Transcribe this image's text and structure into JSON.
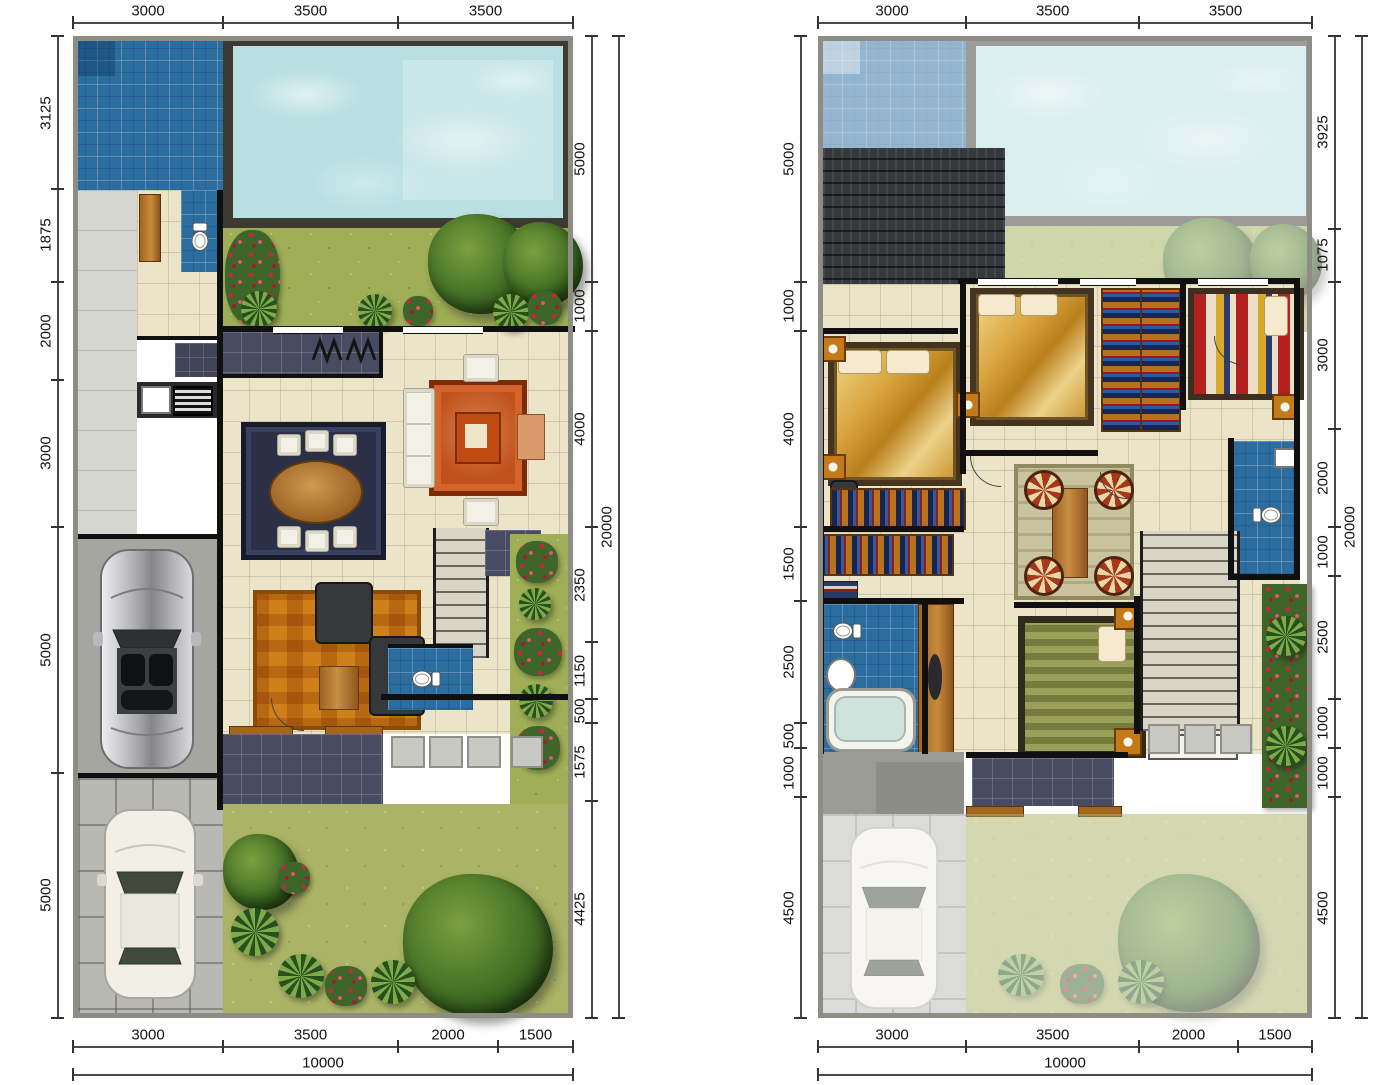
{
  "palette": {
    "pool_water": "#b9dfe2",
    "tile_blue": "#2c6da0",
    "grass": "#9fae57",
    "lawn": "#aab366",
    "deck_dark": "#3c3a31",
    "roof": "#35383c",
    "wall": "#101010",
    "floor_cream": "#ece4c8",
    "paving": "#b9b9b3",
    "wood": "#a4661f",
    "rug_red": "#c0501c",
    "rug_orange": "#d08018",
    "bed_gold": "#d9a43e",
    "dim_text": "#111111"
  },
  "plans": [
    {
      "name": "ground-floor-plan",
      "frame": {
        "left": 73,
        "top": 36,
        "width": 500,
        "height": 982
      },
      "chains": [
        {
          "name": "top",
          "orient": "h",
          "offset": 22,
          "values": [
            3000,
            3500,
            3500
          ]
        },
        {
          "name": "left",
          "orient": "v",
          "offset": 57,
          "values": [
            3125,
            1875,
            2000,
            3000,
            5000,
            5000
          ]
        },
        {
          "name": "right-inner",
          "orient": "v",
          "offset": 591,
          "values": [
            5000,
            1000,
            4000,
            2350,
            1150,
            500,
            1575,
            4425
          ]
        },
        {
          "name": "right-outer",
          "orient": "v",
          "offset": 618,
          "values": [
            20000
          ]
        },
        {
          "name": "bottom-inner",
          "orient": "h",
          "offset": 1046,
          "values": [
            3000,
            3500,
            2000,
            1500
          ]
        },
        {
          "name": "bottom-outer",
          "orient": "h",
          "offset": 1074,
          "values": [
            10000
          ]
        }
      ]
    },
    {
      "name": "upper-floor-plan",
      "frame": {
        "left": 818,
        "top": 36,
        "width": 494,
        "height": 982
      },
      "chains": [
        {
          "name": "top",
          "orient": "h",
          "offset": 22,
          "values": [
            3000,
            3500,
            3500
          ]
        },
        {
          "name": "left",
          "orient": "v",
          "offset": 800,
          "values": [
            5000,
            1000,
            4000,
            1500,
            2500,
            500,
            1000,
            4500
          ]
        },
        {
          "name": "right-inner",
          "orient": "v",
          "offset": 1334,
          "values": [
            3925,
            1075,
            3000,
            2000,
            1000,
            2500,
            1000,
            1000,
            4500
          ]
        },
        {
          "name": "right-outer",
          "orient": "v",
          "offset": 1361,
          "values": [
            20000
          ]
        },
        {
          "name": "bottom-inner",
          "orient": "h",
          "offset": 1046,
          "values": [
            3000,
            3500,
            2000,
            1500
          ]
        },
        {
          "name": "bottom-outer",
          "orient": "h",
          "offset": 1074,
          "values": [
            10000
          ]
        }
      ]
    }
  ]
}
